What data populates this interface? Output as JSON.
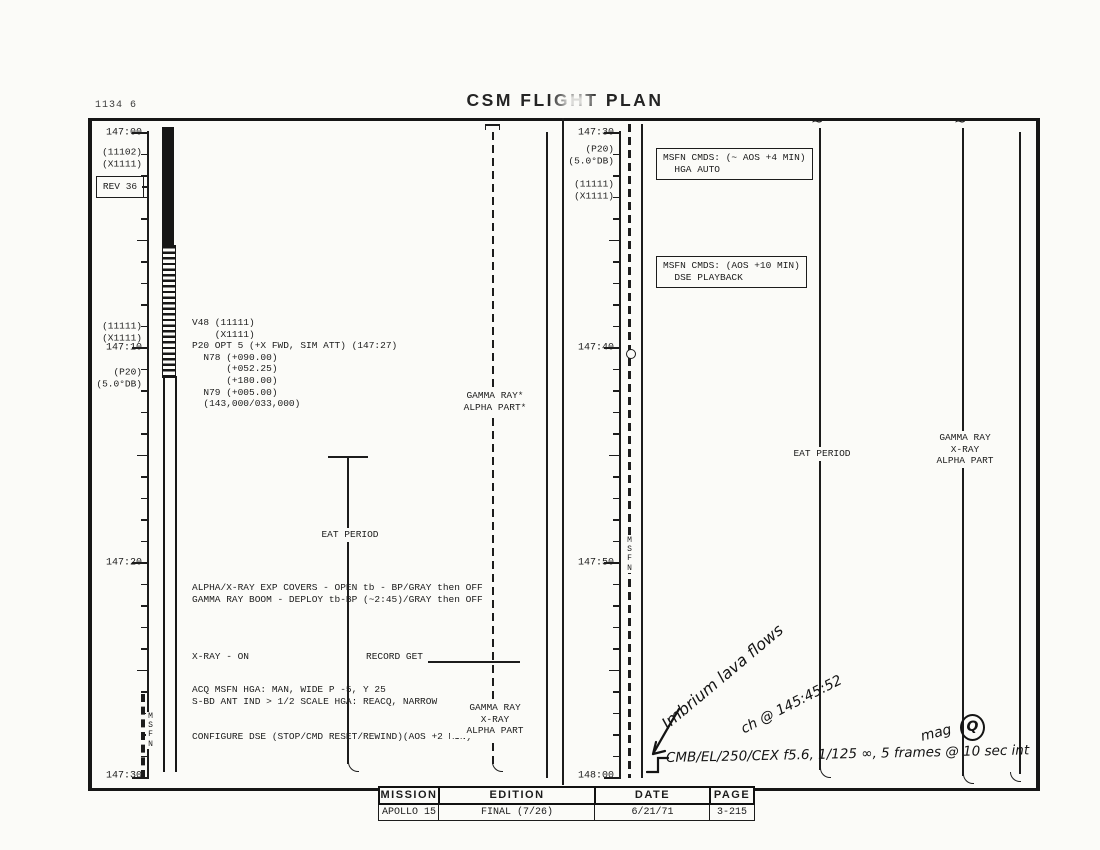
{
  "page": {
    "corner_note": "1134 6",
    "title": "CSM FLIGHT PLAN"
  },
  "left_panel": {
    "time_labels": [
      "147:00",
      "147:10",
      "147:20",
      "147:30"
    ],
    "notes_top": [
      "(11102)",
      "(X1111)"
    ],
    "rev_box": "REV 36",
    "notes_mid_upper": [
      "(11111)",
      "(X1111)"
    ],
    "notes_mid_lower": [
      "(P20)",
      "(5.0°DB)"
    ],
    "msfn_vertical": "MSFN",
    "v48_block": "V48 (11111)\n    (X1111)\nP20 OPT 5 (+X FWD, SIM ATT) (147:27)\n  N78 (+090.00)\n      (+052.25)\n      (+180.00)\n  N79 (+005.00)\n  (143,000/033,000)",
    "gamma_star_label": "GAMMA RAY*\nALPHA PART*",
    "eat_label": "EAT PERIOD",
    "covers_block": "ALPHA/X-RAY EXP COVERS - OPEN tb - BP/GRAY then OFF\nGAMMA RAY BOOM - DEPLOY tb-BP (~2:45)/GRAY then OFF",
    "xray_on": "X-RAY - ON",
    "record_get": "RECORD GET",
    "acq_block": "ACQ MSFN HGA: MAN, WIDE P -5, Y 25\nS-BD ANT IND > 1/2 SCALE HGA: REACQ, NARROW",
    "gamma_bottom_label": "GAMMA RAY\nX-RAY\nALPHA PART",
    "configure_dse": "CONFIGURE DSE (STOP/CMD RESET/REWIND)(AOS +2 MIN)"
  },
  "right_panel": {
    "time_labels": [
      "147:30",
      "147:40",
      "147:50",
      "148:00"
    ],
    "notes_top_a": [
      "(P20)",
      "(5.0°DB)"
    ],
    "notes_top_b": [
      "(11111)",
      "(X1111)"
    ],
    "msfn_vertical": "MSFN",
    "msfn_cmds_box_1": "MSFN CMDS: (~ AOS +4 MIN)\n  HGA AUTO",
    "msfn_cmds_box_2": "MSFN CMDS: (AOS +10 MIN)\n  DSE PLAYBACK",
    "eat_label": "EAT PERIOD",
    "gamma_mid_label": "GAMMA RAY\nX-RAY\nALPHA PART"
  },
  "handwriting": {
    "note_lava": "Imbrium lava flows",
    "note_time": "ch @ 145:45:52",
    "mag": "mag",
    "mag_letter": "Q",
    "camera_line": "CMB/EL/250/CEX  f5.6, 1/125 ∞,  5 frames @ 10 sec int"
  },
  "footer": {
    "headers": [
      "MISSION",
      "EDITION",
      "DATE",
      "PAGE"
    ],
    "values": [
      "APOLLO 15",
      "FINAL (7/26)",
      "6/21/71",
      "3-215"
    ]
  }
}
